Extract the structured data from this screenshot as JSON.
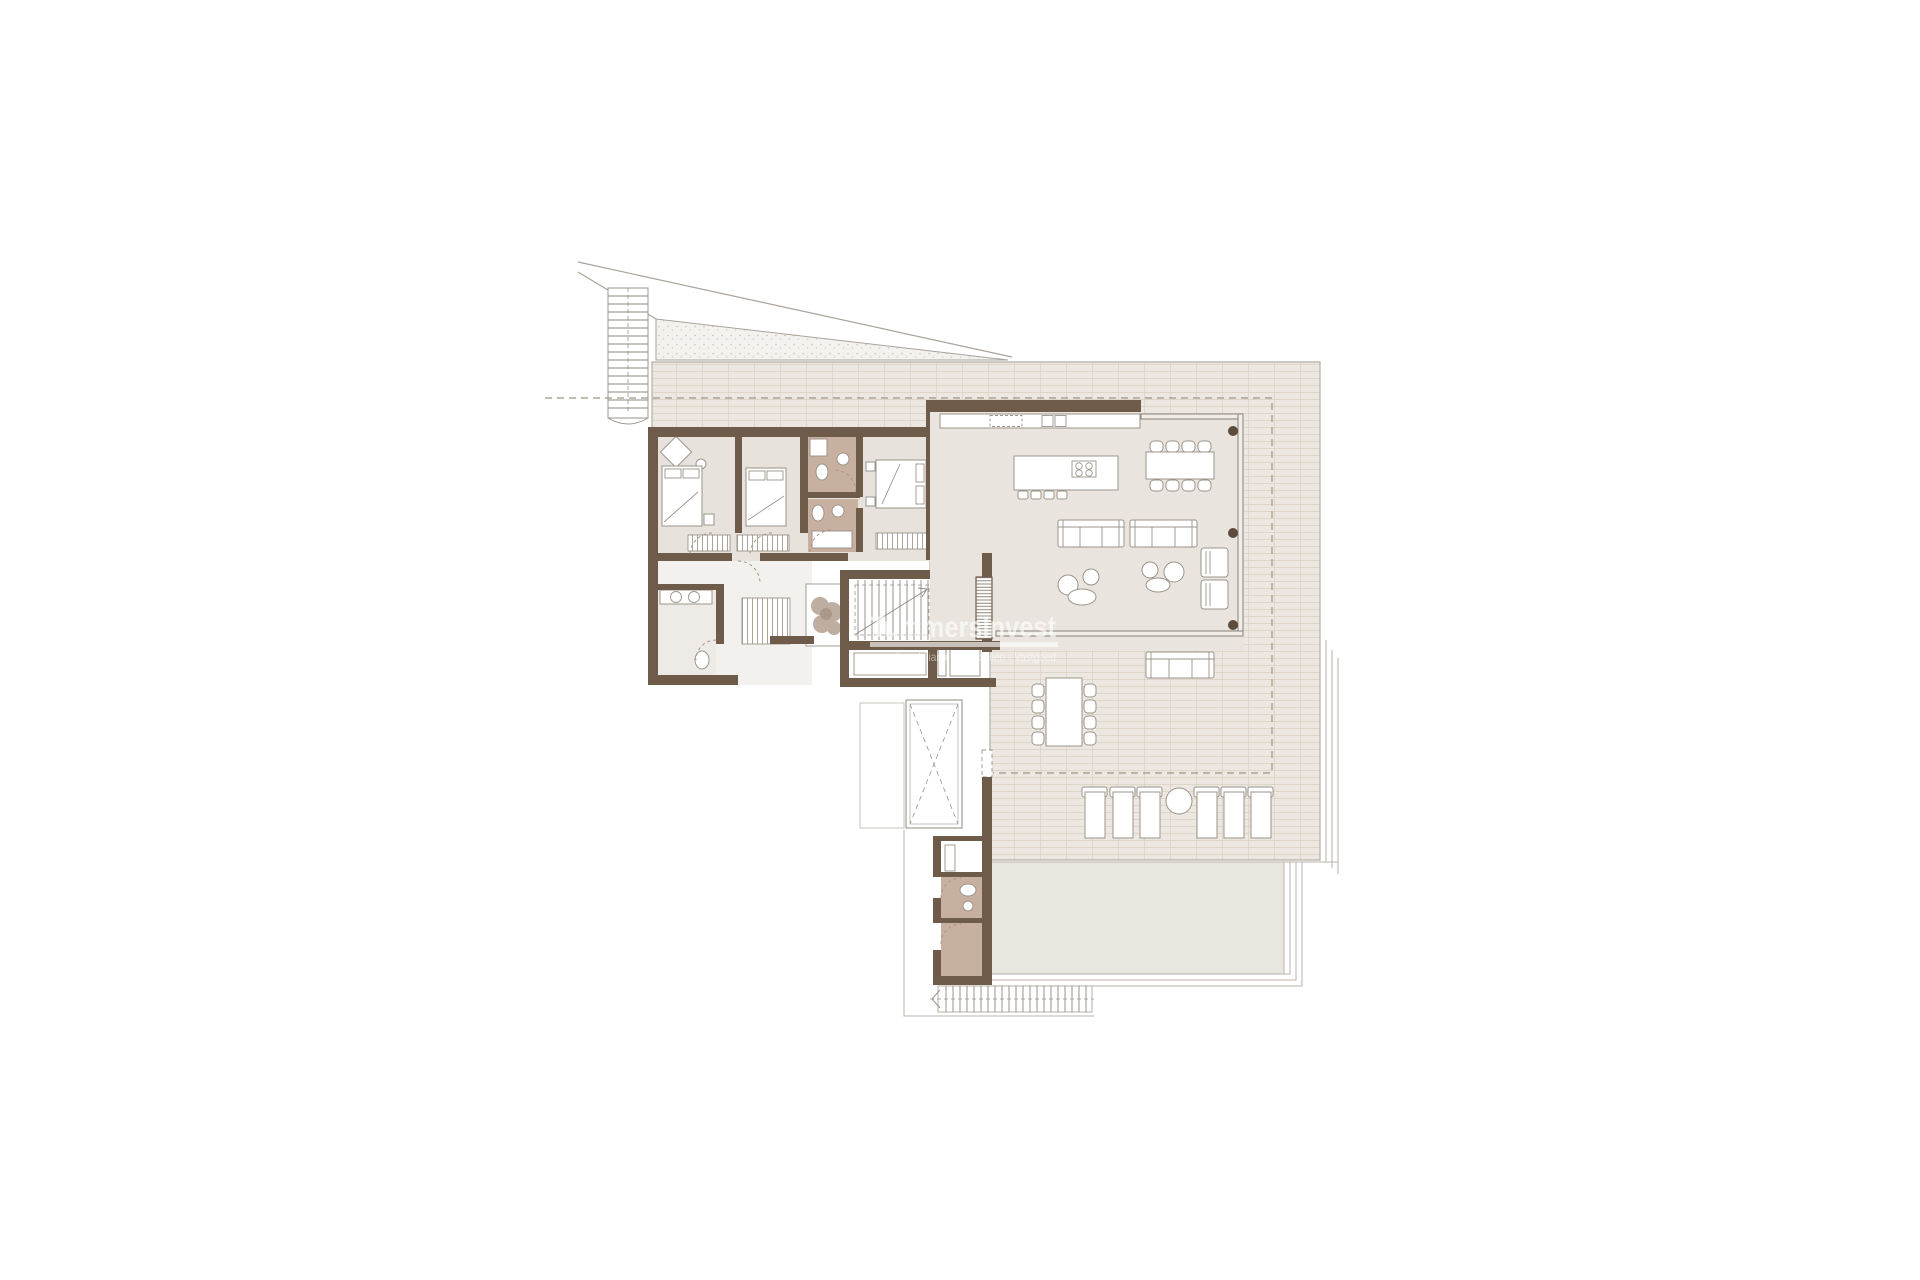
{
  "watermark": {
    "brand": "TummersInvest",
    "tagline": "Inmobiliaria - Immobilien - Vastgoed"
  },
  "palette": {
    "wall": "#6f5b49",
    "floor": "#e7e2db",
    "floor_living": "#e9e4dd",
    "bath_floor": "#c8b0a1",
    "closet": "#b49c8b",
    "tile": "#ece7e1",
    "tile_line": "#c8b9a7",
    "lower_terrace": "#e9e5df",
    "line": "#9b948b",
    "border": "#b8b1a7",
    "site": "#a9a39a",
    "dash": "#9d9682",
    "stipple": "#f4f2ee",
    "accent_dark": "#5d4c3d"
  },
  "plan": {
    "type": "floor-plan",
    "elements": [
      "site-boundary",
      "side-steps",
      "stippled-verge",
      "tiled-terrace",
      "bedroom-1",
      "bedroom-2",
      "bedroom-3",
      "bathroom-1",
      "bathroom-2",
      "bathroom-3",
      "guest-wc",
      "lower-bathroom",
      "corridor",
      "entry-vestibule",
      "staircase",
      "storage-room",
      "elevator-void",
      "planter",
      "wardrobes",
      "living-room",
      "kitchen-counter",
      "kitchen-island",
      "dining-table",
      "sofa-left",
      "sofa-right",
      "lounge-chairs",
      "coffee-tables",
      "outdoor-sofa",
      "outdoor-dining-table",
      "sun-loungers",
      "round-side-table",
      "lower-terrace",
      "garden-steps"
    ],
    "counts": {
      "bedrooms": 3,
      "indoor_dining_chairs": 8,
      "outdoor_dining_chairs": 8,
      "sun_loungers": 6,
      "kitchen_stools": 4,
      "structural_columns": 3
    }
  }
}
